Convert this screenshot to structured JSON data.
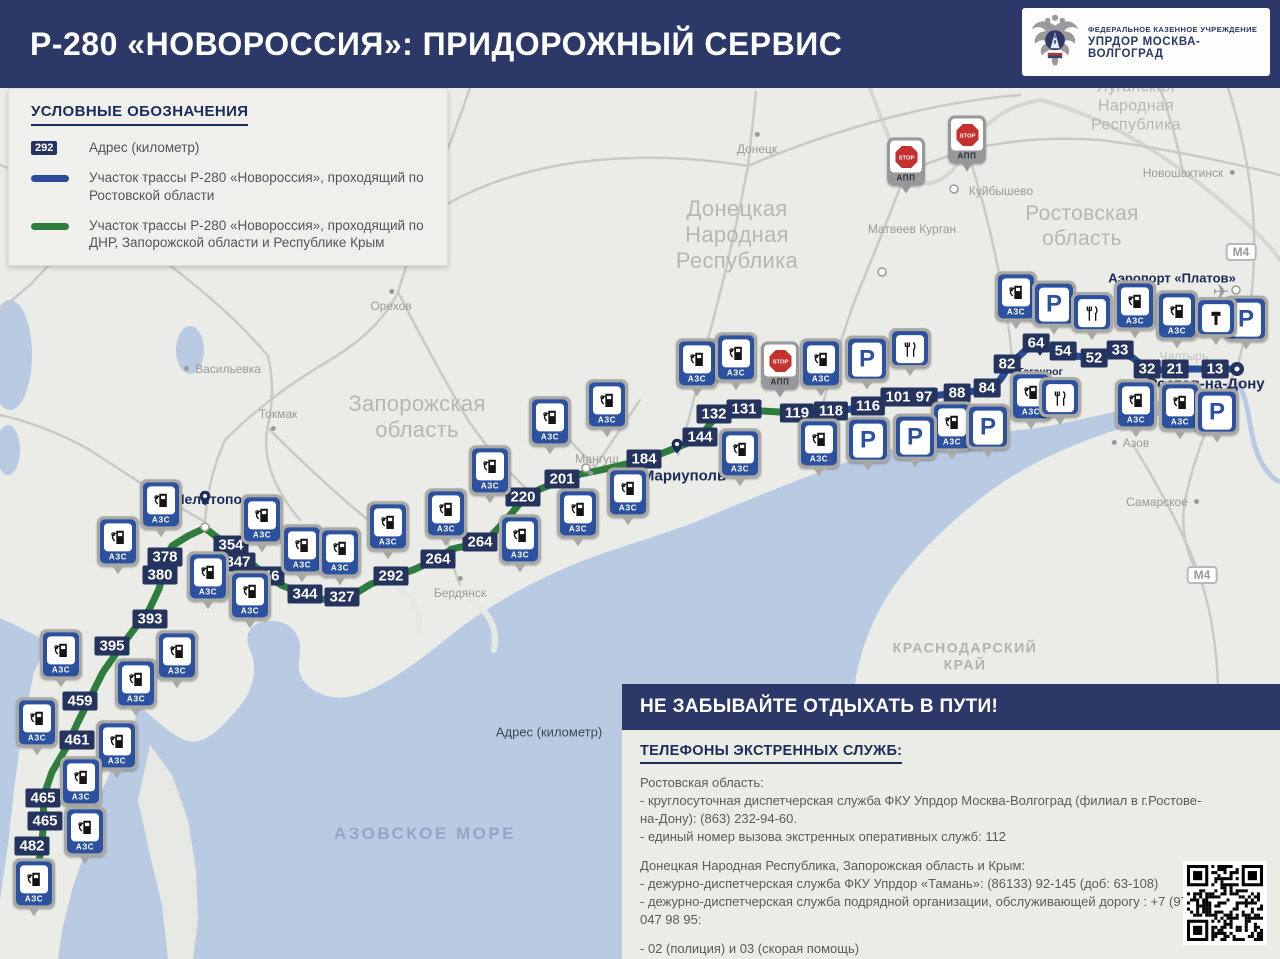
{
  "header": {
    "title": "Р-280 «НОВОРОССИЯ»: ПРИДОРОЖНЫЙ СЕРВИС",
    "logo": {
      "line1": "ФЕДЕРАЛЬНОЕ КАЗЕННОЕ УЧРЕЖДЕНИЕ",
      "line2": "УПРДОР МОСКВА-ВОЛГОГРАД"
    }
  },
  "legend": {
    "title": "УСЛОВНЫЕ ОБОЗНАЧЕНИЯ",
    "items": [
      {
        "type": "badge",
        "sample": "292",
        "text": "Адрес (километр)"
      },
      {
        "type": "line-blue",
        "text": "Участок трассы Р-280 «Новороссия», проходящий по Ростовской области"
      },
      {
        "type": "line-green",
        "text": "Участок трассы Р-280 «Новороссия», проходящий по ДНР, Запорожской области и Республике Крым"
      }
    ]
  },
  "info_panel": {
    "header": "НЕ ЗАБЫВАЙТЕ ОТДЫХАТЬ В ПУТИ!",
    "subheader": "ТЕЛЕФОНЫ ЭКСТРЕННЫХ СЛУЖБ:",
    "sections": [
      {
        "title": "Ростовская область:",
        "lines": [
          "- круглосуточная диспетчерская служба ФКУ Упрдор Москва-Волгоград (филиал в г.Ростове-на-Дону): (863) 232-94-60.",
          "- единый номер вызова экстренных оперативных служб: 112"
        ]
      },
      {
        "title": "Донецкая Народная Республика, Запорожская область и Крым:",
        "lines": [
          "- дежурно-диспетчерская служба ФКУ Упрдор «Тамань»: (86133) 92-145 (доб: 63-108)",
          "- дежурно-диспетчерская служба подрядной организации, обслуживающей дорогу : +7 (978) 047 98 95:"
        ]
      },
      {
        "title": "",
        "lines": [
          "- 02 (полиция) и 03 (скорая помощь)"
        ]
      }
    ]
  },
  "map": {
    "floating_label": "Адрес (километр)",
    "sea_label": {
      "text": "АЗОВСКОЕ МОРЕ",
      "x": 425,
      "y": 834
    },
    "colors": {
      "header_navy": "#2c3867",
      "badge_navy": "#25335f",
      "icon_blue": "#2b51a0",
      "route_blue": "#2b4a9a",
      "route_green": "#2f7d3c",
      "sea": "#b9cbe3",
      "land": "#ebece7",
      "stop_red": "#c4312e",
      "frame_gray": "#a8a8a5"
    },
    "regions": [
      {
        "id": "zaporozhskaya",
        "text": "Запорожская\nобласть",
        "x": 417,
        "y": 417,
        "size": 22
      },
      {
        "id": "dnr",
        "text": "Донецкая\nНародная\nРеспублика",
        "x": 737,
        "y": 235,
        "size": 22
      },
      {
        "id": "rostovskaya",
        "text": "Ростовская\nобласть",
        "x": 1082,
        "y": 227,
        "size": 21
      },
      {
        "id": "lnr",
        "text": "Луганская Народная\nРеспублика",
        "x": 1136,
        "y": 107,
        "size": 16
      },
      {
        "id": "krasnodarsky",
        "text": "КРАСНОДАРСКИЙ\nКРАЙ",
        "x": 965,
        "y": 656,
        "size": 14,
        "caps": true
      }
    ],
    "cities": [
      {
        "label": "Донецк",
        "x": 757,
        "y": 149,
        "style": "gray",
        "dot": "above"
      },
      {
        "label": "Орехов",
        "x": 391,
        "y": 306,
        "style": "gray",
        "dot": "above"
      },
      {
        "label": "Васильевка",
        "x": 228,
        "y": 369,
        "style": "gray",
        "dot": "left"
      },
      {
        "label": "Токмак",
        "x": 278,
        "y": 414,
        "style": "gray",
        "dot": "below"
      },
      {
        "label": "Мангуш",
        "x": 597,
        "y": 459,
        "style": "gray",
        "dot": "below"
      },
      {
        "label": "Бердянск",
        "x": 460,
        "y": 593,
        "style": "gray",
        "dot": "above"
      },
      {
        "label": "Матвеев Курган",
        "x": 912,
        "y": 229,
        "style": "gray",
        "dot": "none"
      },
      {
        "label": "Куйбышево",
        "x": 1001,
        "y": 191,
        "style": "gray",
        "dot": "none"
      },
      {
        "label": "Новошахтинск",
        "x": 1183,
        "y": 173,
        "style": "gray",
        "dot": "right"
      },
      {
        "label": "Азов",
        "x": 1136,
        "y": 443,
        "style": "gray",
        "dot": "left"
      },
      {
        "label": "Самарское",
        "x": 1157,
        "y": 502,
        "style": "gray",
        "dot": "right"
      },
      {
        "label": "Чалтырь",
        "x": 1184,
        "y": 356,
        "style": "gray",
        "dot": "none",
        "faint": true
      },
      {
        "label": "Мелитополь",
        "x": 216,
        "y": 499,
        "style": "navy",
        "size": 14,
        "pin": {
          "x": 205,
          "y": 514
        }
      },
      {
        "label": "Мариуполь",
        "x": 684,
        "y": 476,
        "style": "navy",
        "size": 15,
        "pin": {
          "x": 677,
          "y": 462
        }
      },
      {
        "label": "Таганрог",
        "x": 1040,
        "y": 372,
        "style": "navy",
        "size": 10.5,
        "pin": {
          "x": 1040,
          "y": 364
        }
      },
      {
        "label": "Ростов-на-Дону",
        "x": 1206,
        "y": 384,
        "style": "navy",
        "size": 15
      },
      {
        "label": "Аэропорт «Платов»",
        "x": 1172,
        "y": 278,
        "style": "navy",
        "size": 13
      }
    ],
    "airplane": {
      "x": 1221,
      "y": 292,
      "glyph": "✈"
    },
    "m4_signs": [
      {
        "label": "М4",
        "x": 1241,
        "y": 252
      },
      {
        "label": "М4",
        "x": 1202,
        "y": 575
      }
    ],
    "km_markers": [
      {
        "km": "378",
        "x": 165,
        "y": 557
      },
      {
        "km": "380",
        "x": 160,
        "y": 575
      },
      {
        "km": "354",
        "x": 231,
        "y": 545
      },
      {
        "km": "347",
        "x": 238,
        "y": 562
      },
      {
        "km": "346",
        "x": 267,
        "y": 576
      },
      {
        "km": "344",
        "x": 305,
        "y": 594
      },
      {
        "km": "327",
        "x": 342,
        "y": 597
      },
      {
        "km": "292",
        "x": 391,
        "y": 576
      },
      {
        "km": "264",
        "x": 438,
        "y": 559
      },
      {
        "km": "264",
        "x": 480,
        "y": 542
      },
      {
        "km": "220",
        "x": 523,
        "y": 497
      },
      {
        "km": "201",
        "x": 562,
        "y": 479
      },
      {
        "km": "184",
        "x": 644,
        "y": 459
      },
      {
        "km": "144",
        "x": 700,
        "y": 437
      },
      {
        "km": "132",
        "x": 714,
        "y": 414
      },
      {
        "km": "131",
        "x": 744,
        "y": 409
      },
      {
        "km": "119",
        "x": 797,
        "y": 413
      },
      {
        "km": "118",
        "x": 831,
        "y": 411
      },
      {
        "km": "116",
        "x": 868,
        "y": 406
      },
      {
        "km": "101",
        "x": 898,
        "y": 397
      },
      {
        "km": "97",
        "x": 924,
        "y": 397
      },
      {
        "km": "88",
        "x": 957,
        "y": 393
      },
      {
        "km": "84",
        "x": 987,
        "y": 388
      },
      {
        "km": "82",
        "x": 1007,
        "y": 364
      },
      {
        "km": "64",
        "x": 1036,
        "y": 343
      },
      {
        "km": "54",
        "x": 1063,
        "y": 351
      },
      {
        "km": "52",
        "x": 1094,
        "y": 358
      },
      {
        "km": "33",
        "x": 1120,
        "y": 350
      },
      {
        "km": "32",
        "x": 1147,
        "y": 369
      },
      {
        "km": "21",
        "x": 1175,
        "y": 369
      },
      {
        "km": "13",
        "x": 1215,
        "y": 369
      },
      {
        "km": "393",
        "x": 150,
        "y": 619
      },
      {
        "km": "395",
        "x": 112,
        "y": 646
      },
      {
        "km": "459",
        "x": 80,
        "y": 701
      },
      {
        "km": "461",
        "x": 77,
        "y": 740
      },
      {
        "km": "465",
        "x": 43,
        "y": 798
      },
      {
        "km": "465",
        "x": 45,
        "y": 821
      },
      {
        "km": "482",
        "x": 32,
        "y": 846
      }
    ],
    "icons": [
      {
        "t": "azs",
        "x": 161,
        "y": 513
      },
      {
        "t": "azs",
        "x": 118,
        "y": 550
      },
      {
        "t": "azs",
        "x": 262,
        "y": 528
      },
      {
        "t": "azs",
        "x": 302,
        "y": 558
      },
      {
        "t": "azs",
        "x": 340,
        "y": 561
      },
      {
        "t": "azs",
        "x": 208,
        "y": 585
      },
      {
        "t": "azs",
        "x": 250,
        "y": 604
      },
      {
        "t": "azs",
        "x": 61,
        "y": 663
      },
      {
        "t": "azs",
        "x": 177,
        "y": 664
      },
      {
        "t": "azs",
        "x": 136,
        "y": 692
      },
      {
        "t": "azs",
        "x": 37,
        "y": 731
      },
      {
        "t": "azs",
        "x": 117,
        "y": 754
      },
      {
        "t": "azs",
        "x": 81,
        "y": 790
      },
      {
        "t": "azs",
        "x": 85,
        "y": 840
      },
      {
        "t": "azs",
        "x": 34,
        "y": 892
      },
      {
        "t": "azs",
        "x": 388,
        "y": 535
      },
      {
        "t": "azs",
        "x": 446,
        "y": 522
      },
      {
        "t": "azs",
        "x": 490,
        "y": 479
      },
      {
        "t": "azs",
        "x": 520,
        "y": 548
      },
      {
        "t": "azs",
        "x": 578,
        "y": 522
      },
      {
        "t": "azs",
        "x": 550,
        "y": 430
      },
      {
        "t": "azs",
        "x": 607,
        "y": 413
      },
      {
        "t": "azs",
        "x": 628,
        "y": 501
      },
      {
        "t": "azs",
        "x": 697,
        "y": 372
      },
      {
        "t": "azs",
        "x": 736,
        "y": 366
      },
      {
        "t": "azs",
        "x": 740,
        "y": 462
      },
      {
        "t": "azs",
        "x": 821,
        "y": 372
      },
      {
        "t": "azs",
        "x": 819,
        "y": 452
      },
      {
        "t": "azs",
        "x": 952,
        "y": 435
      },
      {
        "t": "azs",
        "x": 1016,
        "y": 305
      },
      {
        "t": "azs",
        "x": 1135,
        "y": 314
      },
      {
        "t": "azs",
        "x": 1177,
        "y": 324
      },
      {
        "t": "azs",
        "x": 1031,
        "y": 405
      },
      {
        "t": "azs",
        "x": 1136,
        "y": 413
      },
      {
        "t": "azs",
        "x": 1180,
        "y": 415
      },
      {
        "t": "parking",
        "x": 867,
        "y": 367
      },
      {
        "t": "parking",
        "x": 868,
        "y": 448
      },
      {
        "t": "parking",
        "x": 915,
        "y": 445
      },
      {
        "t": "parking",
        "x": 988,
        "y": 435
      },
      {
        "t": "parking",
        "x": 1054,
        "y": 312
      },
      {
        "t": "parking",
        "x": 1246,
        "y": 327
      },
      {
        "t": "parking",
        "x": 1217,
        "y": 420
      },
      {
        "t": "food",
        "x": 910,
        "y": 356
      },
      {
        "t": "food",
        "x": 1092,
        "y": 320
      },
      {
        "t": "food",
        "x": 1060,
        "y": 405
      },
      {
        "t": "service",
        "x": 1216,
        "y": 325
      },
      {
        "t": "stop",
        "x": 780,
        "y": 374,
        "cap": "АПП"
      },
      {
        "t": "stop",
        "x": 906,
        "y": 170,
        "cap": "АПП"
      },
      {
        "t": "stop",
        "x": 967,
        "y": 148,
        "cap": "АПП"
      }
    ],
    "icon_caps": {
      "azs": "АЗС",
      "stop_sign_word": "STOP"
    }
  }
}
